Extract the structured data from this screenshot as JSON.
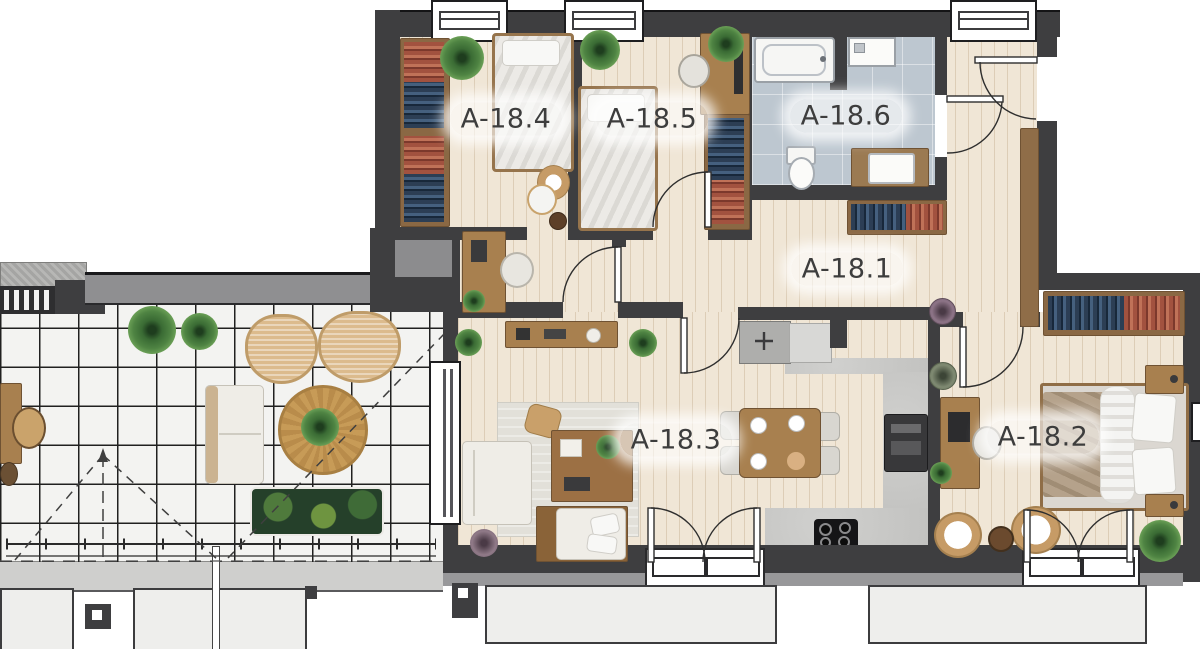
{
  "plan_title": "",
  "rooms": [
    {
      "id": "a-18-1",
      "label": "A-18.1",
      "type": "hallway"
    },
    {
      "id": "a-18-2",
      "label": "A-18.2",
      "type": "bedroom"
    },
    {
      "id": "a-18-3",
      "label": "A-18.3",
      "type": "living-room"
    },
    {
      "id": "a-18-4",
      "label": "A-18.4",
      "type": "bedroom"
    },
    {
      "id": "a-18-5",
      "label": "A-18.5",
      "type": "bedroom"
    },
    {
      "id": "a-18-6",
      "label": "A-18.6",
      "type": "bathroom"
    }
  ],
  "colors": {
    "wall": "#3e3e40",
    "wood_floor": "#f0e6d6",
    "bathroom_tile": "#bdc7d0",
    "terrace_tile": "#f3f3f1",
    "kitchen_concrete": "#c9c9c7",
    "furniture_wood": "#a8804f",
    "label_text": "#3d3d3d"
  }
}
